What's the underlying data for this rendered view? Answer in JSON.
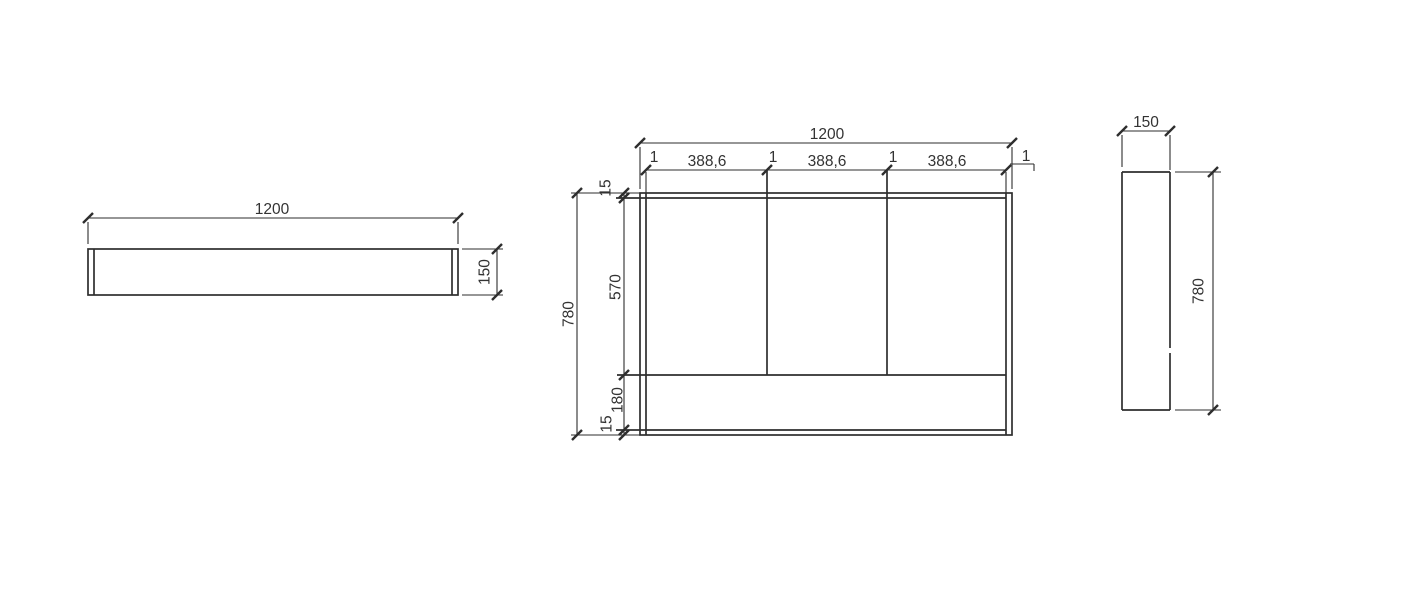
{
  "drawing_title": "cabinet-three-view-dimension-drawing",
  "views": {
    "top": {
      "width_label": "1200",
      "depth_label": "150"
    },
    "front": {
      "width_label": "1200",
      "height_label": "780",
      "section_labels": [
        "388,6",
        "388,6",
        "388,6"
      ],
      "gap_labels": [
        "1",
        "1",
        "1",
        "1"
      ],
      "top_panel_label": "15",
      "upper_section_label": "570",
      "lower_section_label": "180",
      "bottom_panel_label": "15"
    },
    "side": {
      "depth_label": "150",
      "height_label": "780"
    }
  },
  "colors": {
    "line": "#2e2e2e",
    "text": "#333333",
    "background": "#ffffff"
  }
}
